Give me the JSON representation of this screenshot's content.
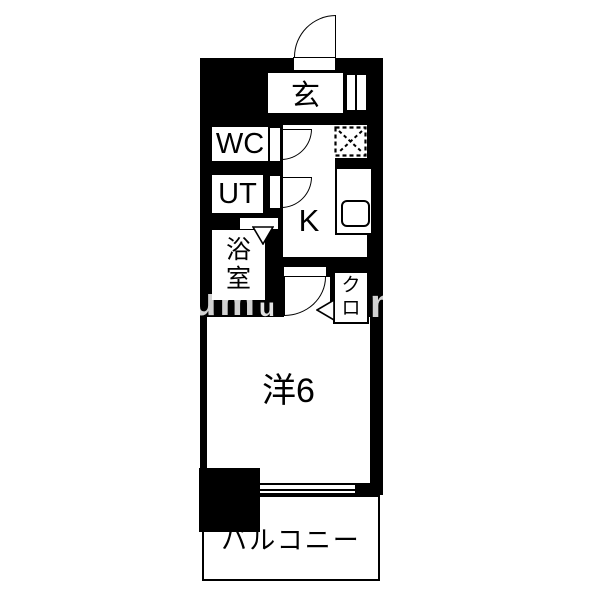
{
  "colors": {
    "wall": "#000000",
    "background": "#ffffff"
  },
  "rooms": {
    "entrance": {
      "label": "玄"
    },
    "toilet": {
      "label": "WC"
    },
    "utility": {
      "label": "UT"
    },
    "bathroom": {
      "label": "浴室"
    },
    "kitchen": {
      "label": "K"
    },
    "closet": {
      "label": "クロ"
    },
    "western_room": {
      "label": "洋6"
    },
    "balcony": {
      "label": "バルコニー"
    }
  },
  "watermark": {
    "left": "um",
    "middle": "u",
    "right": "m"
  }
}
